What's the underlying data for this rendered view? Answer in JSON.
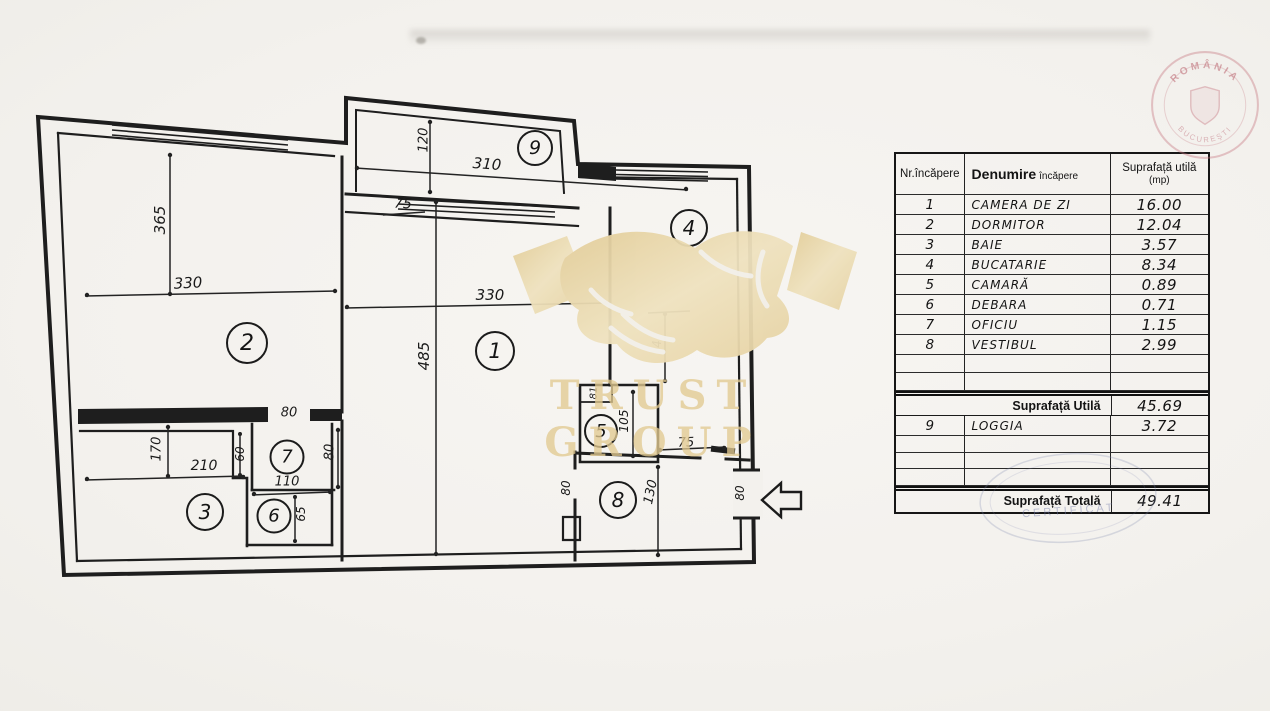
{
  "watermark": {
    "brand": "TRUST GROUP",
    "gold_color": "#e5cf9c"
  },
  "stamps": {
    "country": "ROMÂNIA",
    "city": "BUCUREŞTI",
    "certificate": "CERTIFICAT"
  },
  "plan": {
    "rooms": [
      {
        "number": "1"
      },
      {
        "number": "2"
      },
      {
        "number": "3"
      },
      {
        "number": "4"
      },
      {
        "number": "5"
      },
      {
        "number": "6"
      },
      {
        "number": "7"
      },
      {
        "number": "8"
      },
      {
        "number": "9"
      }
    ],
    "dimensions": [
      {
        "text": "365"
      },
      {
        "text": "330"
      },
      {
        "text": "120"
      },
      {
        "text": "310"
      },
      {
        "text": "75"
      },
      {
        "text": "330"
      },
      {
        "text": "485"
      },
      {
        "text": "80"
      },
      {
        "text": "170"
      },
      {
        "text": "210"
      },
      {
        "text": "60"
      },
      {
        "text": "110"
      },
      {
        "text": "65"
      },
      {
        "text": "80"
      },
      {
        "text": "81"
      },
      {
        "text": "105"
      },
      {
        "text": "75"
      },
      {
        "text": "80"
      },
      {
        "text": "130"
      },
      {
        "text": "80"
      },
      {
        "text": "4"
      }
    ]
  },
  "table": {
    "h_nr": "Nr.încăpere",
    "h_name_main": "Denumire",
    "h_name_sub": "încăpere",
    "h_area_main": "Suprafață utilă",
    "h_area_sub": "(mp)",
    "rows": [
      {
        "nr": "1",
        "name": "CAMERA DE ZI",
        "area": "16.00"
      },
      {
        "nr": "2",
        "name": "DORMITOR",
        "area": "12.04"
      },
      {
        "nr": "3",
        "name": "BAIE",
        "area": "3.57"
      },
      {
        "nr": "4",
        "name": "BUCATARIE",
        "area": "8.34"
      },
      {
        "nr": "5",
        "name": "CAMARĂ",
        "area": "0.89"
      },
      {
        "nr": "6",
        "name": "DEBARA",
        "area": "0.71"
      },
      {
        "nr": "7",
        "name": "OFICIU",
        "area": "1.15"
      },
      {
        "nr": "8",
        "name": "VESTIBUL",
        "area": "2.99"
      }
    ],
    "subtotal_label": "Suprafață Utilă",
    "subtotal_value": "45.69",
    "loggia": {
      "nr": "9",
      "name": "LOGGIA",
      "area": "3.72"
    },
    "total_label": "Suprafață Totală",
    "total_value": "49.41"
  }
}
